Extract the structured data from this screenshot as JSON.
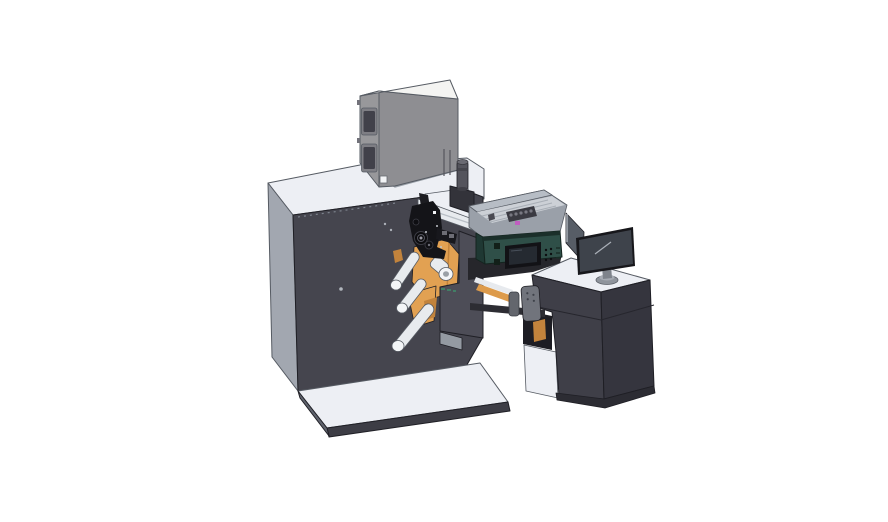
{
  "canvas": {
    "width": 888,
    "height": 522
  },
  "scene": {
    "type": "3d-cad-render",
    "subject": "Label printing machine line: main unwind cabinet with guide rollers, electronics box, digital print unit with control screen, media enclosure and operator desk with monitor",
    "background": "#ffffff",
    "palette": {
      "surface_white": "#edeff4",
      "cabinet_front": "#45454e",
      "cabinet_side": "#a2a7b0",
      "platform_front": "#3d3d45",
      "platform_edge": "#5f636d",
      "box_top": "#f4f4f2",
      "box_left": "#98989b",
      "box_front": "#8e8e92",
      "box_window": "#41414a",
      "box_window_frame": "#7e7e84",
      "cylinder_gray": "#54545c",
      "ramp_white": "#e7eaee",
      "mech_black": "#141418",
      "orange": "#e2a152",
      "orange_dark": "#c2833c",
      "roller": "#e8ebee",
      "roller_cap": "#f3f5f7",
      "carriage": "#4d4d57",
      "carriage_foot": "#949aa2",
      "teal_face": "#2f4f48",
      "teal_side": "#1f3833",
      "teal_rim": "#1b2f2a",
      "screen_bezel": "#121216",
      "screen_glass": "#252a31",
      "enclosure_wall": "#b7bdc5",
      "enclosure_wall_dark": "#9aa0a9",
      "enclosure_floor": "#ccd0d6",
      "magenta": "#c05fc0",
      "desk_front": "#3f3f48",
      "desk_side": "#35353e",
      "desk_shadow": "#1d1d23",
      "bracket_gray": "#71747c",
      "panel_gray": "#575d66",
      "monitor_bezel": "#17171b",
      "monitor_glass": "#3e434b",
      "monitor_stand": "#8f949c",
      "belt_orange": "#dd9b4b",
      "under_dark": "#26262b",
      "arm_dark": "#2d2d33",
      "green_mark": "#3f8f6a",
      "dark_block": "#33333a",
      "base_dark": "#2c2c33"
    },
    "components": [
      {
        "id": "main-cabinet"
      },
      {
        "id": "base-platform"
      },
      {
        "id": "electronics-box"
      },
      {
        "id": "exhaust-cylinder"
      },
      {
        "id": "web-path-mechanism"
      },
      {
        "id": "media-enclosure"
      },
      {
        "id": "operator-desk"
      },
      {
        "id": "digital-print-unit"
      },
      {
        "id": "side-panel"
      },
      {
        "id": "desktop-monitor"
      }
    ]
  }
}
